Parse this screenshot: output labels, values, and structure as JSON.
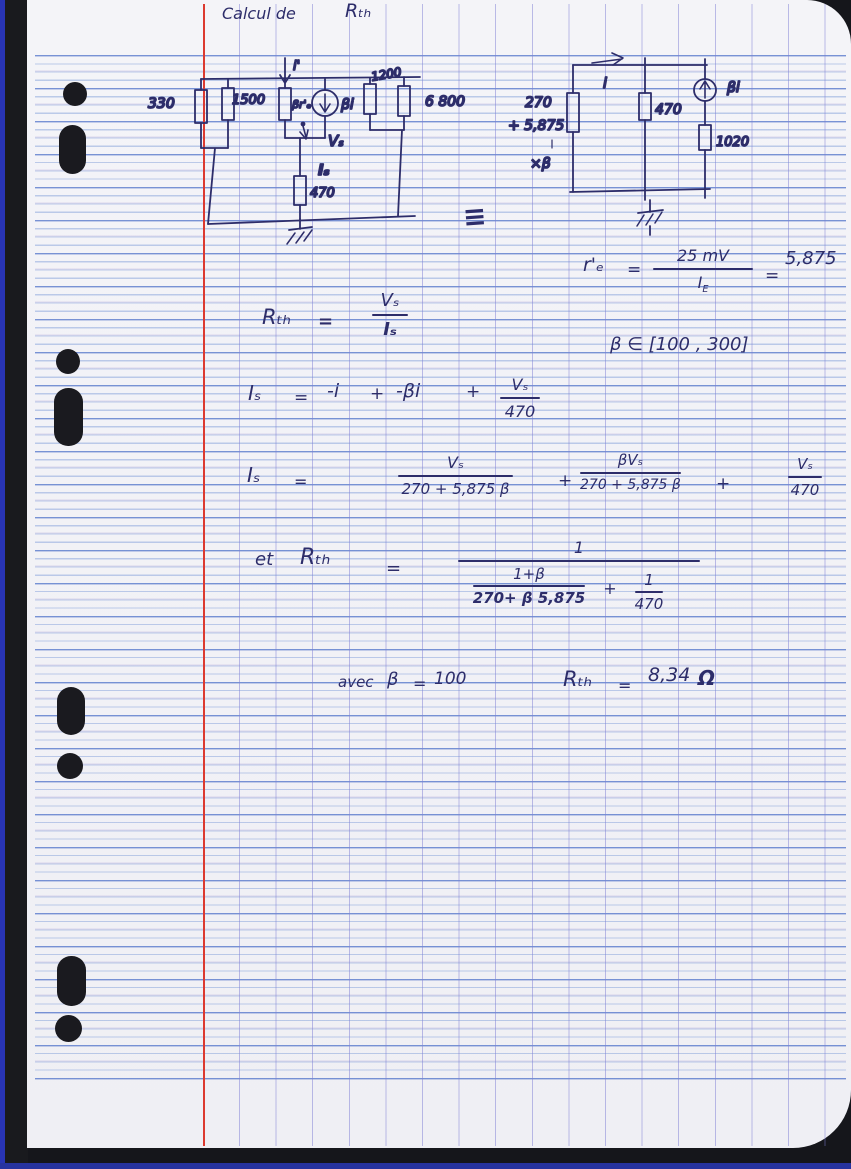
{
  "title": {
    "calcul_de": "Calcul de",
    "rth": "Rₜₕ"
  },
  "circuit_left": {
    "r330": "330",
    "r1500": "1500",
    "i_prime": "i'",
    "beta_re": "βr'ₑ",
    "beta_i": "βi",
    "r1200": "1200",
    "r6800": "6 800",
    "vs": "Vₛ",
    "is": "Iₛ",
    "r470": "470"
  },
  "equiv_sign": "≡",
  "circuit_right": {
    "i": "i",
    "rsrc_l1": "270",
    "rsrc_l2": "+ 5,875",
    "rsrc_l3": "×β",
    "r470": "470",
    "beta_i": "βi",
    "r1020": "1020"
  },
  "eq_re": {
    "lhs": "r'ₑ",
    "equals": "=",
    "num": "25 mV",
    "den_base": "I",
    "den_sub": "E",
    "equals2": "=",
    "value": "5,875"
  },
  "eq_beta_range": {
    "text": "β ∈ [100 , 300]"
  },
  "eq_rth_def": {
    "lhs": "Rₜₕ",
    "equals": "=",
    "num": "Vₛ",
    "den": "Iₛ"
  },
  "eq_is_sum": {
    "lhs": "Iₛ",
    "equals": "=",
    "t1": "-i",
    "plus1": "+",
    "t2": "-βi",
    "plus2": "+",
    "num": "Vₛ",
    "den": "470"
  },
  "eq_is_expanded": {
    "lhs": "Iₛ",
    "equals": "=",
    "f1_num": "Vₛ",
    "f1_den": "270 + 5,875 β",
    "plus1": "+",
    "f2_num": "βVₛ",
    "f2_den": "270 + 5,875 β",
    "plus2": "+",
    "f3_num": "Vₛ",
    "f3_den": "470"
  },
  "eq_rth_result": {
    "et": "et",
    "lhs": "Rₜₕ",
    "equals": "=",
    "num": "1",
    "sub1_num": "1+β",
    "sub1_den": "270+ β 5,875",
    "plus": "+",
    "sub2_num": "1",
    "sub2_den": "470"
  },
  "eq_final": {
    "avec": "avec",
    "beta": "β",
    "equals": "=",
    "beta_val": "100",
    "lhs": "Rₜₕ",
    "equals2": "=",
    "value": "8,34",
    "unit": "Ω"
  },
  "colors": {
    "ink": "#2d2d6a",
    "margin_red": "#dc3a30",
    "rule_blue": "#7696d6"
  }
}
